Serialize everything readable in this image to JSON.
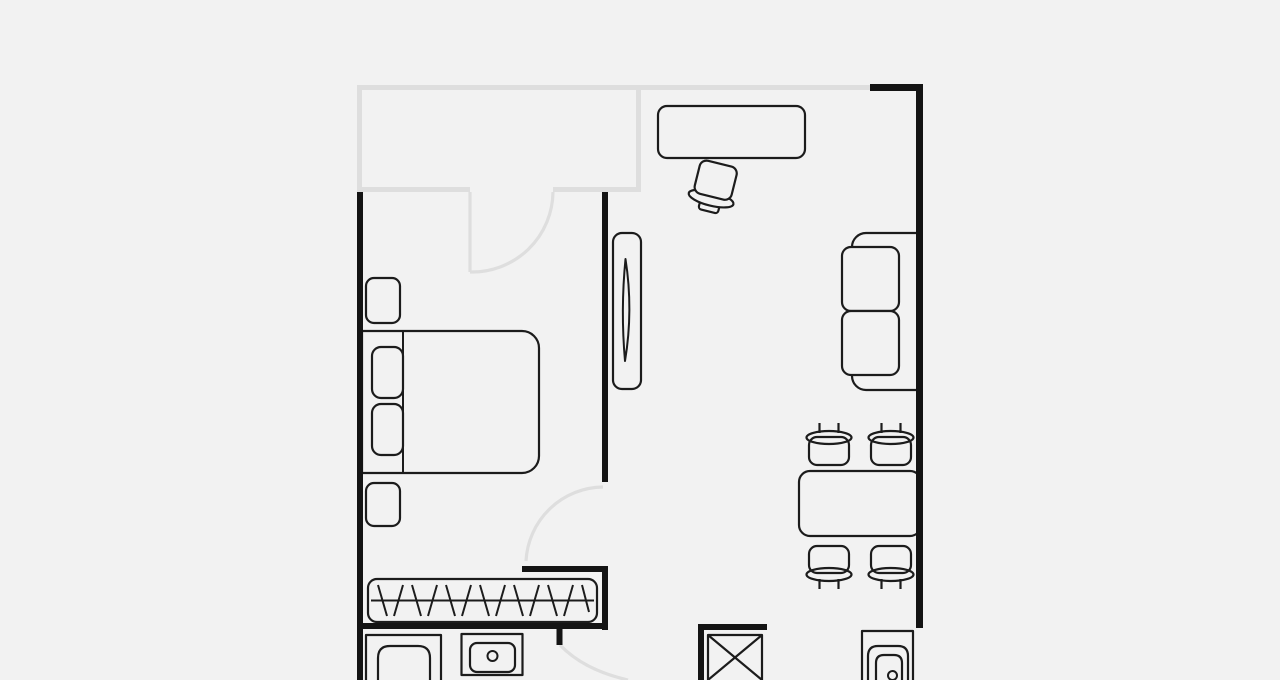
{
  "document": {
    "kind": "apartment-floor-plan",
    "orientation": "top-down"
  },
  "palette": {
    "background": "#f2f2f2",
    "wall": "#141414",
    "wall_light": "#dedede",
    "furniture_line": "#1c1c1c"
  },
  "rooms": [
    {
      "name": "balcony",
      "walls": "light-gray outline, top-left"
    },
    {
      "name": "bedroom",
      "walls": "black, left side"
    },
    {
      "name": "living-room",
      "walls": "black, right side"
    },
    {
      "name": "hallway",
      "walls": "center bottom"
    },
    {
      "name": "bathroom-kitchen-strip",
      "walls": "bottom edge, cut off by image border"
    }
  ],
  "doors": [
    {
      "name": "balcony-door",
      "style": "gray quarter-circle swing into bedroom"
    },
    {
      "name": "bedroom-door",
      "style": "gray quarter-circle swing at bottom of divider wall"
    },
    {
      "name": "bathroom-door",
      "style": "gray swing arc at bottom edge"
    }
  ],
  "furniture": [
    {
      "name": "double-bed",
      "room": "bedroom",
      "details": "headboard line and two pillows on left"
    },
    {
      "name": "nightstand-top",
      "room": "bedroom"
    },
    {
      "name": "nightstand-bottom",
      "room": "bedroom"
    },
    {
      "name": "tall-mirror-cabinet",
      "room": "bedroom",
      "details": "narrow cabinet with lens-shaped mirror mark"
    },
    {
      "name": "wardrobe-with-hangers",
      "room": "hallway-niche",
      "details": "rounded box, rod line, 13 hanger strokes"
    },
    {
      "name": "desk",
      "room": "living-room"
    },
    {
      "name": "office-chair",
      "room": "living-room",
      "details": "rotated swivel chair"
    },
    {
      "name": "two-seat-sofa",
      "room": "living-room",
      "details": "against right wall, two cushions"
    },
    {
      "name": "dining-table",
      "room": "living-room",
      "details": "against right wall"
    },
    {
      "name": "dining-chair",
      "count": 4,
      "details": "two above table, two below, each with back bar and two posts"
    },
    {
      "name": "sink-unit-left",
      "room": "bottom-strip",
      "details": "cut off at image bottom"
    },
    {
      "name": "basin-with-drain",
      "room": "bottom-strip",
      "details": "small circle drain"
    },
    {
      "name": "ventilation-shaft",
      "room": "bottom-strip",
      "details": "box with X cross"
    },
    {
      "name": "toilet",
      "room": "bottom-strip",
      "details": "nested rounded rects with small circle, cut off"
    }
  ]
}
